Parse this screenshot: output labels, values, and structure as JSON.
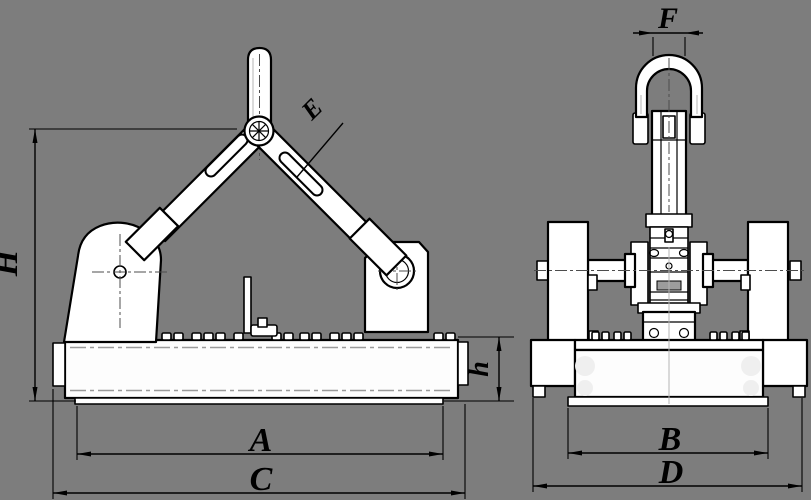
{
  "drawing": {
    "kind": "technical-drawing-lifting-magnet",
    "background_color": "#7d7d7d",
    "line_color": "#000000",
    "fill_color": "#ffffff",
    "front_view": {
      "name": "front view",
      "dim_height": "H",
      "dim_pad_width": "A",
      "dim_overall_width": "C",
      "dim_base_height": "h",
      "label_arm": "E"
    },
    "side_view": {
      "name": "side view",
      "dim_shackle_width": "F",
      "dim_pad_width": "B",
      "dim_overall_width": "D"
    }
  }
}
